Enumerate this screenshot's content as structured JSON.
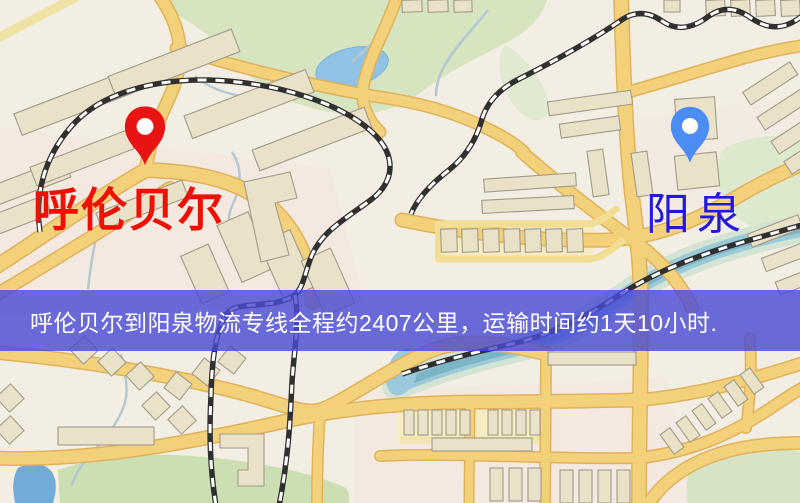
{
  "banner": {
    "text": "呼伦贝尔到阳泉物流专线全程约2407公里，运输时间约1天10小时.",
    "background_color": "#4a4cd4",
    "text_color": "#ffffff"
  },
  "route": {
    "origin": "呼伦贝尔",
    "destination": "阳泉",
    "distance_text": "约2407公里",
    "duration_text": "约1天10小时"
  },
  "markers": {
    "origin": {
      "label": "呼伦贝尔",
      "pin_color": "#e81414",
      "label_color": "#ee1003"
    },
    "destination": {
      "label": "阳泉",
      "pin_color": "#4b8df2",
      "label_color": "#2318dd"
    }
  },
  "map": {
    "kind": "street-map",
    "road_color": "#f2d17a",
    "park_color": "#d6e4c0",
    "water_color": "#8fc2e4",
    "railway_color": "#303030",
    "background_color": "#f3eee4"
  }
}
